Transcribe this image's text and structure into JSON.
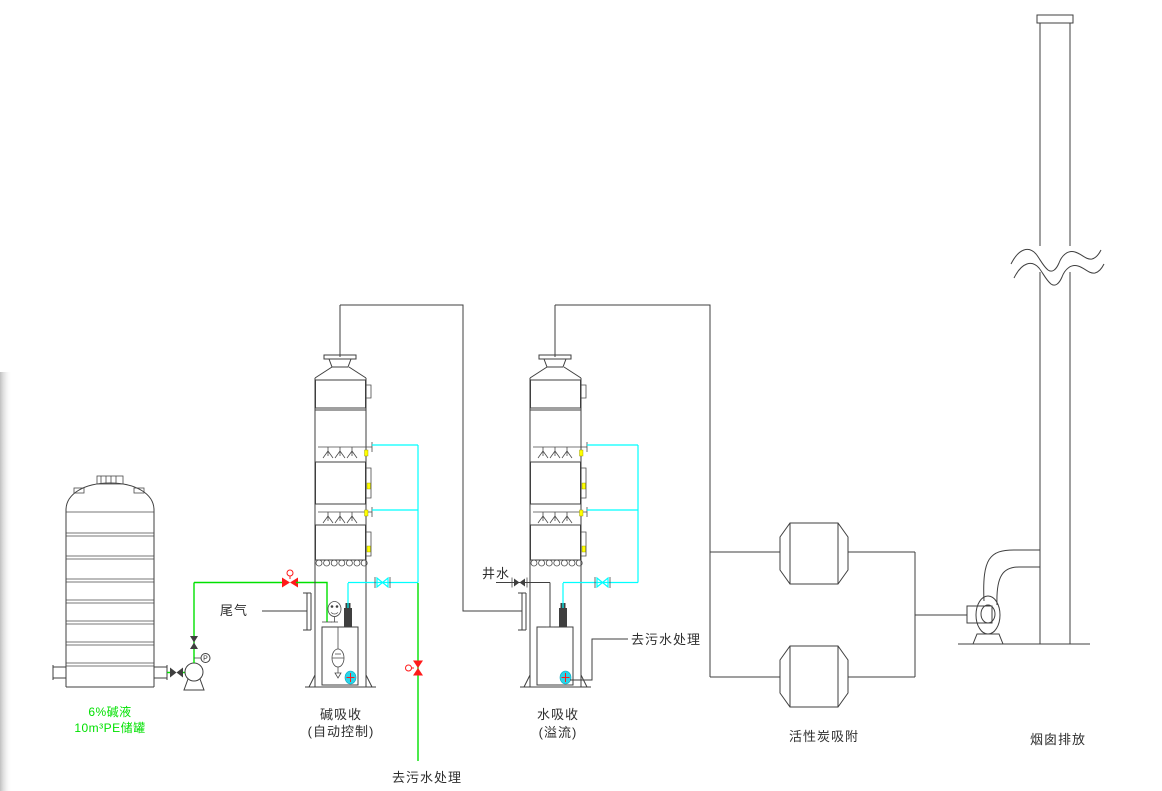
{
  "diagram": {
    "title_implicit": "waste-gas scrubbing process flow diagram",
    "labels": {
      "tank_line1": "6%碱液",
      "tank_line2": "10m³PE储罐",
      "tail_gas": "尾气",
      "tower1_line1": "碱吸收",
      "tower1_line2": "(自动控制)",
      "sewage_bottom": "去污水处理",
      "well_water": "井水",
      "tower2_line1": "水吸收",
      "tower2_line2": "(溢流)",
      "sewage_right": "去污水处理",
      "carbon": "活性炭吸附",
      "chimney": "烟囱排放",
      "pressure_gauge": "P"
    },
    "colors": {
      "line": "#3f3f3f",
      "alkali_line_green": "#00e100",
      "water_line_cyan": "#00ffff",
      "valve_red": "#ff1a1a",
      "nozzle_yellow": "#ffff00"
    }
  }
}
